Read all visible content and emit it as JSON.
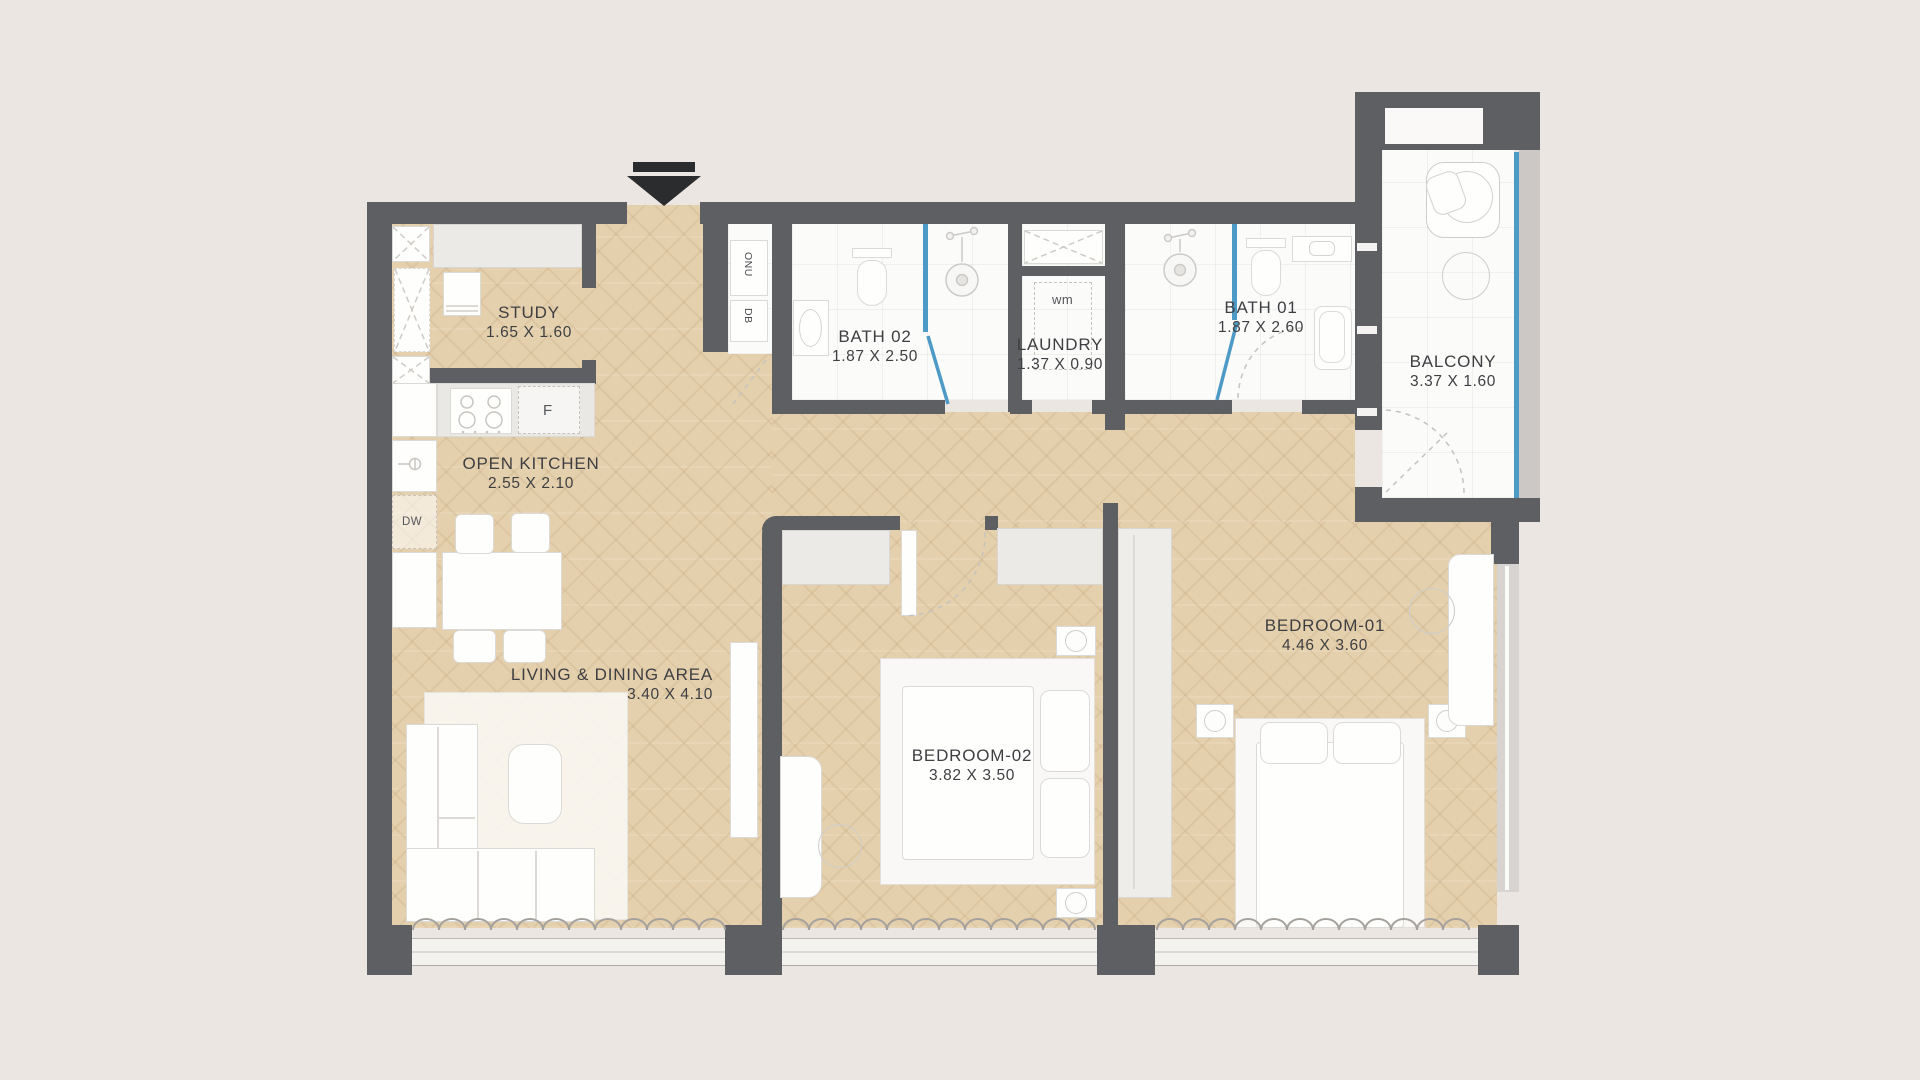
{
  "plan": {
    "title": "2-bedroom apartment floor plan",
    "rooms": {
      "study": {
        "name": "STUDY",
        "dims": "1.65 X 1.60"
      },
      "kitchen": {
        "name": "OPEN KITCHEN",
        "dims": "2.55 X 2.10"
      },
      "living": {
        "name": "LIVING & DINING AREA",
        "dims": "3.40 X 4.10"
      },
      "bath02": {
        "name": "BATH 02",
        "dims": "1.87 X 2.50"
      },
      "laundry": {
        "name": "LAUNDRY",
        "dims": "1.37 X 0.90"
      },
      "bath01": {
        "name": "BATH 01",
        "dims": "1.87 X 2.60"
      },
      "balcony": {
        "name": "BALCONY",
        "dims": "3.37 X 1.60"
      },
      "bedroom02": {
        "name": "BEDROOM-02",
        "dims": "3.82 X 3.50"
      },
      "bedroom01": {
        "name": "BEDROOM-01",
        "dims": "4.46 X 3.60"
      }
    },
    "appliances": {
      "fridge": "F",
      "dishwasher": "DW",
      "washing_machine": "wm"
    },
    "utilities": {
      "onu": "ONU",
      "db": "DB"
    },
    "icons": {
      "entrance_arrow": "filled-triangle-down"
    },
    "colors": {
      "background": "#EBE6E2",
      "wall": "#5E5F63",
      "wood_floor": "#E5D0AD",
      "tile_floor": "#FBFBFA",
      "glass": "#4E9AC6",
      "text": "#3E3F42"
    }
  }
}
